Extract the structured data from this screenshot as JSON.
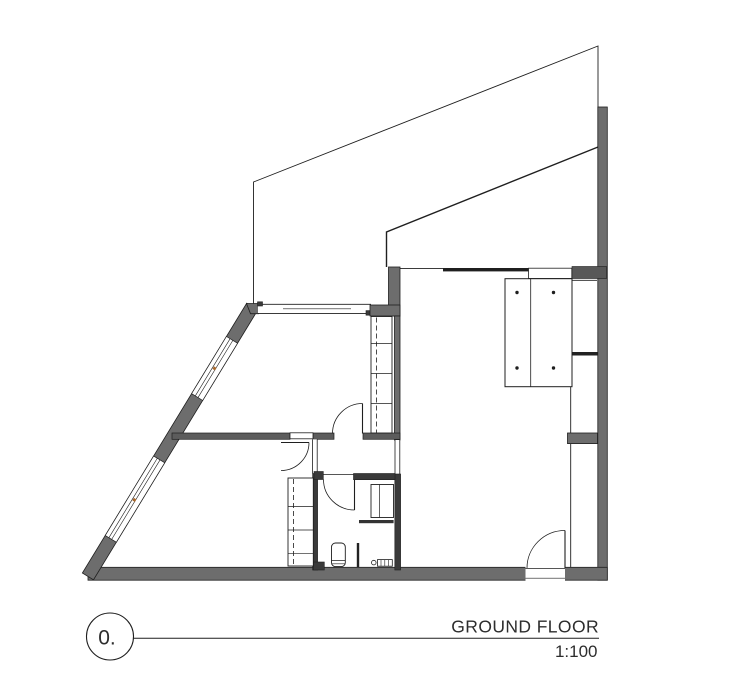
{
  "drawing": {
    "floor_label": "0.",
    "title": "GROUND FLOOR",
    "scale": "1:100"
  },
  "colors": {
    "wall_gray": "#6d6d6d",
    "wall_mid": "#5c5c5c",
    "wall_dark": "#3a3a3a",
    "line": "#1f1f1f",
    "accent": "#a8682c",
    "text": "#2d2d2d",
    "background": "#ffffff"
  }
}
